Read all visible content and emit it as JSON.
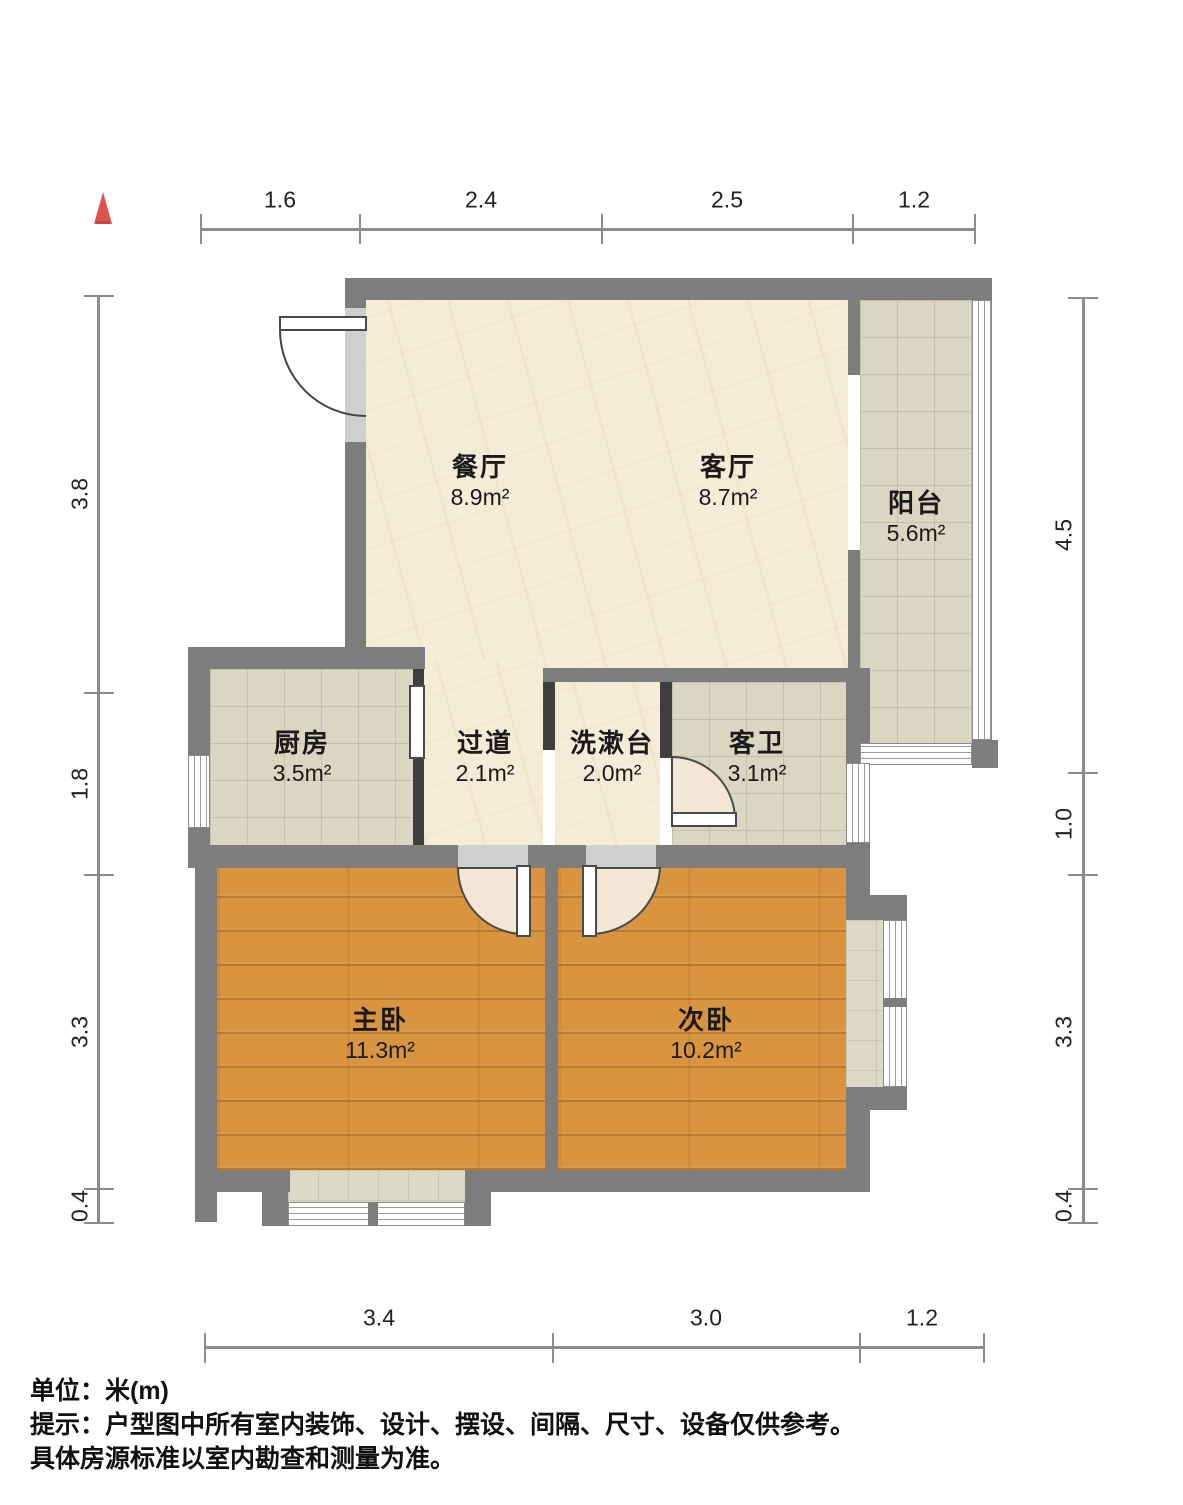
{
  "rooms": [
    {
      "name": "餐厅",
      "area": "8.9m²"
    },
    {
      "name": "客厅",
      "area": "8.7m²"
    },
    {
      "name": "阳台",
      "area": "5.6m²"
    },
    {
      "name": "厨房",
      "area": "3.5m²"
    },
    {
      "name": "过道",
      "area": "2.1m²"
    },
    {
      "name": "洗漱台",
      "area": "2.0m²"
    },
    {
      "name": "客卫",
      "area": "3.1m²"
    },
    {
      "name": "主卧",
      "area": "11.3m²"
    },
    {
      "name": "次卧",
      "area": "10.2m²"
    }
  ],
  "dimensions": {
    "top": [
      "1.6",
      "2.4",
      "2.5",
      "1.2"
    ],
    "left": [
      "3.8",
      "1.8",
      "3.3",
      "0.4"
    ],
    "right": [
      "4.5",
      "1.0",
      "3.3",
      "0.4"
    ],
    "bottom": [
      "3.4",
      "3.0",
      "1.2"
    ]
  },
  "footer": {
    "unit_line": "单位：米(m)",
    "tip_line1": "提示：户型图中所有室内装饰、设计、摆设、间隔、尺寸、设备仅供参考。",
    "tip_line2": "具体房源标准以室内勘查和测量为准。"
  },
  "colors": {
    "wall": "#7d7d7d",
    "wall_dark": "#3f3f3f",
    "marble_floor": "#f5ecd8",
    "tile_floor": "#d9d6c1",
    "wood_floor": "#d9943f",
    "north_arrow_red": "#e0524d",
    "dimension_gray": "#8c8c8c"
  },
  "icons": {
    "north": "north-arrow"
  }
}
